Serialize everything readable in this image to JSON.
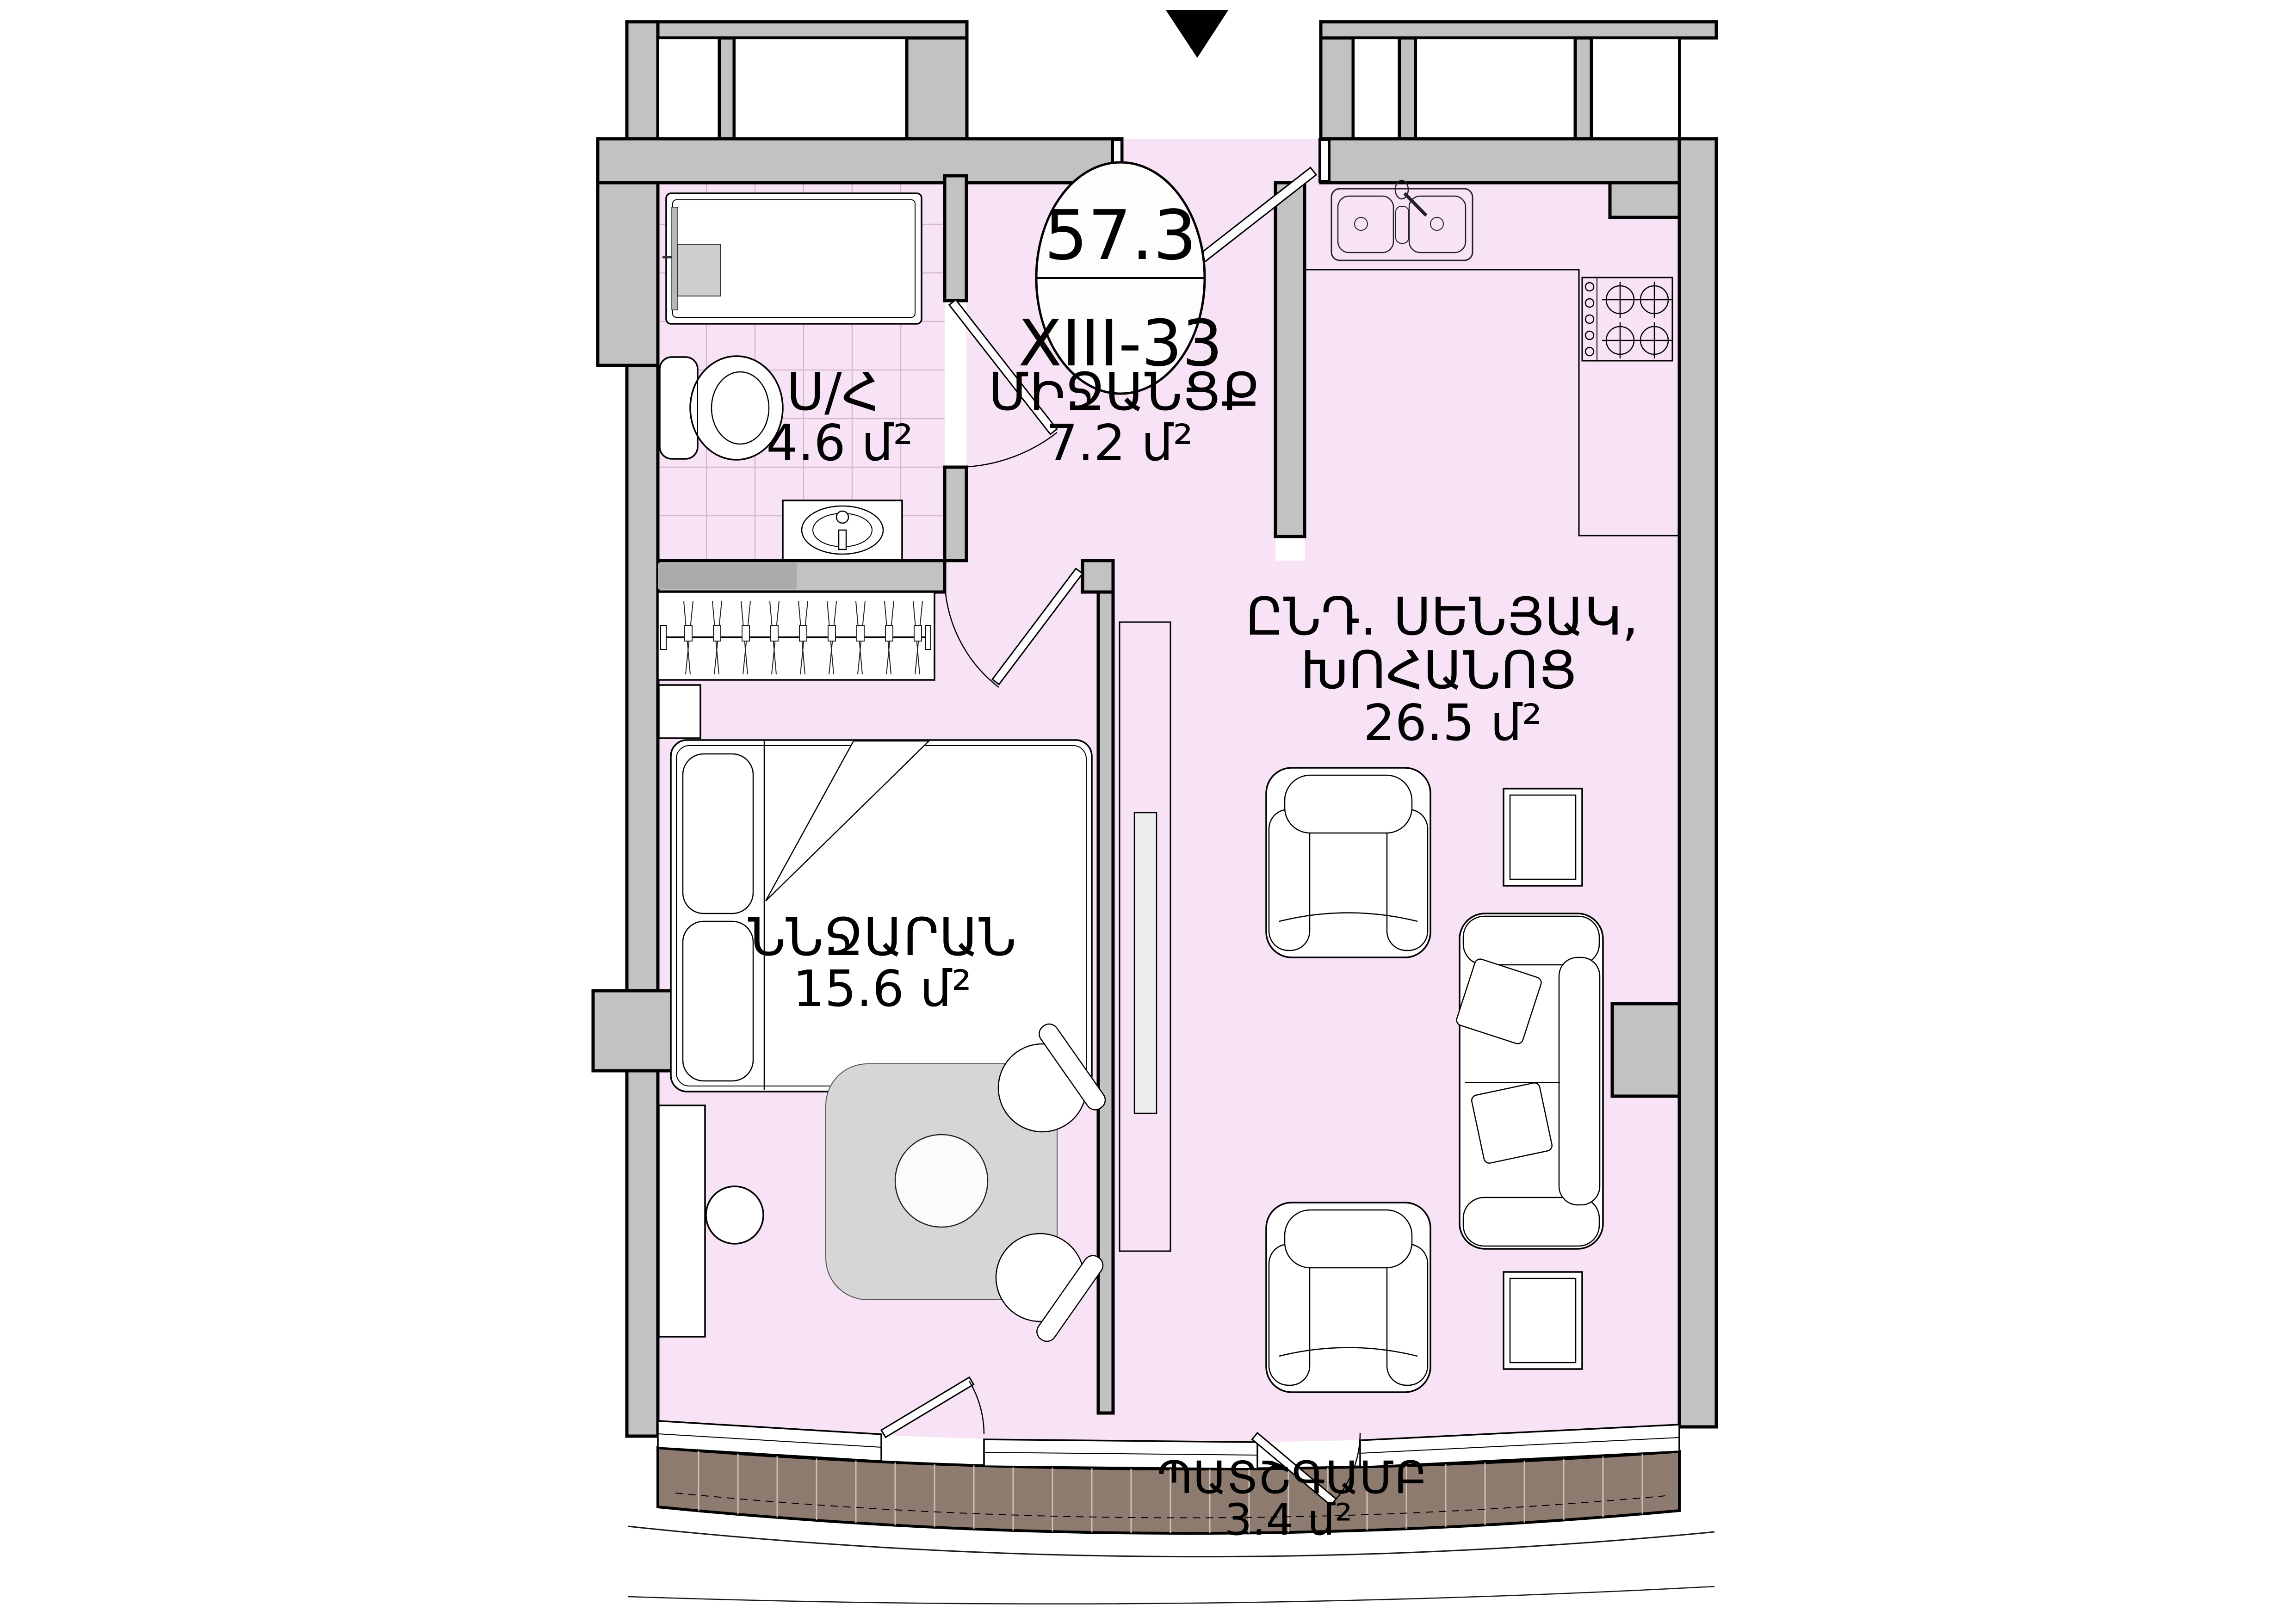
{
  "badge": {
    "area_total": "57.3",
    "unit_code": "XIII-33"
  },
  "rooms": {
    "hallway": {
      "name": "ՄԻՋԱՆՑՔ",
      "area": "7.2 մ²"
    },
    "bathroom": {
      "name": "Ս/Հ",
      "area": "4.6 մ²"
    },
    "living_kitchen": {
      "name_line1": "ԸՆԴ. ՍԵՆՅԱԿ,",
      "name_line2": "ԽՈՀԱՆՈՑ",
      "area": "26.5 մ²"
    },
    "bedroom": {
      "name": "ՆՆՋԱՐԱՆ",
      "area": "15.6 մ²"
    },
    "balcony": {
      "name": "ՊԱՏՇԳԱՄԲ",
      "area": "3.4 մ²"
    }
  },
  "colors": {
    "floor_pink": "#f8e2f5",
    "tile_line": "#d4b8cd",
    "wall_gray": "#c2c2c2",
    "balcony_brown": "#8d7b6f",
    "line_black": "#000000"
  }
}
